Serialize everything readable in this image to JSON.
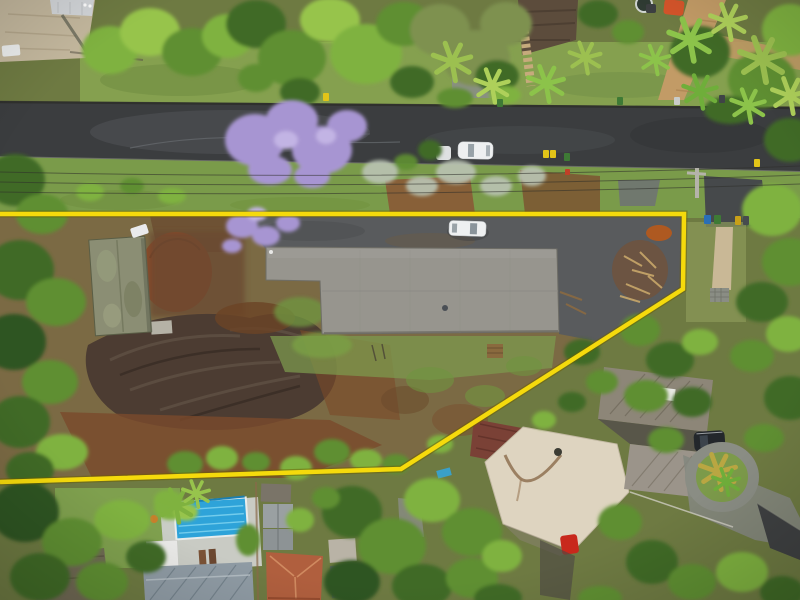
{
  "image": {
    "type": "aerial-drone-photograph",
    "subject": "cleared residential block outlined with a yellow property boundary beside a suburban street",
    "no_text_present": true
  },
  "boundary": {
    "points": "0,214 684,214 683,289 401,469 0,482",
    "color": "#f2d80a",
    "outline_color": "#6b5e00"
  },
  "colors": {
    "road": "#3b3d3f",
    "verge_grass": "#7a9b4a",
    "lawn": "#85a04f",
    "interior_ground": "#7b6a44",
    "dirt_red": "#8a4a28",
    "dirt_dark": "#4c3c32",
    "driveway": "#595b5d",
    "main_roof": "#97958e",
    "shed_roof": "#8b8e74",
    "pool_water": "#2ea3d9",
    "pool_deck": "#cdd0cb",
    "cream_roof": "#ded4c0",
    "terracotta_roof": "#b05f3e",
    "bluegrey_roof": "#8f9ba4",
    "dark_roof": "#6f6754",
    "maroon_roof": "#7a4136",
    "corrugated_roof": "#8d8678",
    "pavers": "#c4b89e",
    "brick_driveway": "#c29b66",
    "white_car": "#eef0f1",
    "orange_car": "#d4542a",
    "red_car": "#c8281c",
    "black_car": "#23272b"
  },
  "scene": {
    "street_cars_parked": 2,
    "car_inside_property": 1,
    "wheelie_bins_visible": 12,
    "swimming_pool": "blue, lap style, lower left neighbour",
    "jacaranda_trees": 2,
    "power_lines": "run along the grass verge between street and boundary"
  }
}
